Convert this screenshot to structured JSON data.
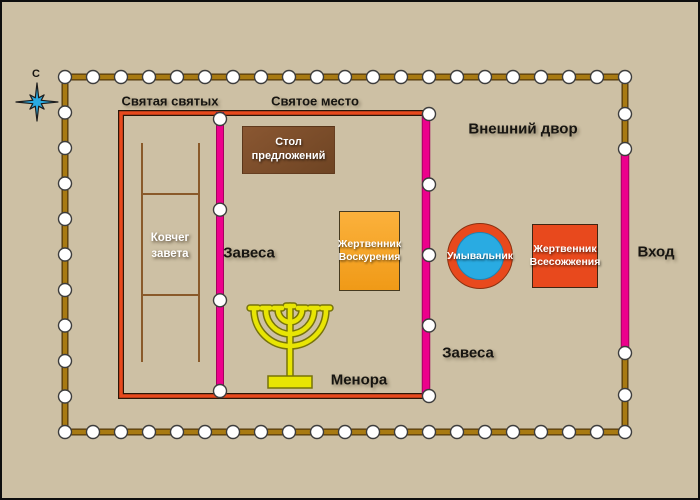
{
  "compass": {
    "north_label": "С"
  },
  "zones": {
    "holy_of_holies": "Святая святых",
    "holy_place": "Святое место",
    "outer_court": "Внешний двор"
  },
  "labels": {
    "inner_veil": "Завеса",
    "court_veil": "Завеса",
    "menorah": "Менора",
    "entrance": "Вход"
  },
  "furniture": {
    "ark": "Ковчег завета",
    "showbread_table": "Стол предложений",
    "incense_altar": "Жертвенник Воскурения",
    "laver": "Умывальник",
    "burnt_offering_altar": "Жертвенник Всесожжения"
  },
  "colors": {
    "background": "#cdc0a4",
    "fence_brown": "#a87a12",
    "tent_border_red": "#e8491d",
    "veil_pink": "#ec008c",
    "post_white": "#ffffff",
    "laver_blue": "#29abe2",
    "incense_orange": "#f7a623",
    "table_brown": "#7a4a28",
    "burnt_altar_red": "#e8491d",
    "menorah_yellow": "#e8e504",
    "compass_blue": "#29abe2"
  }
}
